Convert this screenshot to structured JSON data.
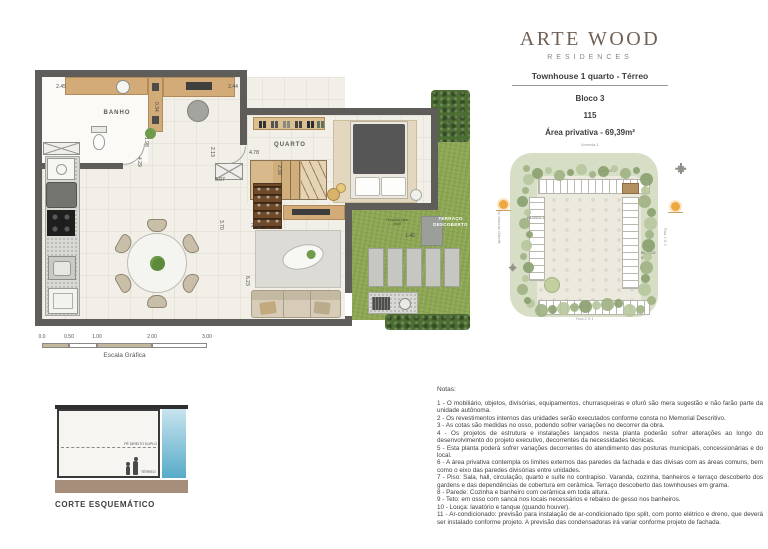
{
  "header": {
    "brand": "ARTE WOOD",
    "brand_subtitle": "RESIDENCES",
    "unit_type": "Townhouse 1 quarto - Térreo",
    "block": "Bloco 3",
    "unit_number": "115",
    "private_area": "Área privativa - 69,39m²"
  },
  "floor_plan": {
    "room_labels": {
      "bathroom": "BANHO",
      "bedroom": "QUARTO",
      "terrace": "TERRAÇO DESCOBERTO"
    },
    "terrace_note": "Previsão para ofurô",
    "dimensions": [
      "2.45",
      "2.44",
      "0.34",
      "1.98",
      "4.29",
      "2.13",
      "4.78",
      "2.39",
      "5.07",
      "3.70",
      "2.96",
      "6.23",
      "1.40",
      "5.47"
    ]
  },
  "scale_bar": {
    "ticks": [
      "0.0",
      "0.50",
      "1.00",
      "2.00",
      "3.00"
    ],
    "label": "Escala Gráfica"
  },
  "site_plan": {
    "streets": {
      "top": "Avenida 1",
      "right": "Rua 2 S 2",
      "bottom": "Rua 2 S 1",
      "left": "Av. Antonio Gabrilli"
    },
    "blocks": [
      {
        "label": "BLOCO 2"
      },
      {
        "label": "BLOCO 4"
      },
      {
        "label": "BLOCO 3"
      },
      {
        "label": "BLOCO 1"
      }
    ]
  },
  "section": {
    "title": "CORTE ESQUEMÁTICO",
    "ceiling_label": "PÉ DIREITO DUPLO",
    "floor_label": "TÉRREO"
  },
  "notes": {
    "title": "Notas:",
    "items": [
      "1 - O mobiliário, objetos, divisórias, equipamentos, churrasqueiras e ofurô são mera sugestão e não farão parte da unidade autônoma.",
      "2 - Os revestimentos internos das unidades serão executados conforme consta no Memorial Descritivo.",
      "3 - As cotas são medidas no osso, podendo sofrer variações no decorrer da obra.",
      "4 - Os projetos de estrutura e instalações lançados nesta planta poderão sofrer alterações ao longo do desenvolvimento do projeto executivo, decorrentes da necessidades técnicas.",
      "5 - Esta planta poderá sofrer variações decorrentes do atendimento das posturas municipais, concessionárias e do local.",
      "6 - A área privativa contempla os limites externos das paredes da fachada e das divisas com as áreas comuns, bem como o eixo das paredes divisórias entre unidades.",
      "7 - Piso: Sala, hall, circulação, quarto e suíte no contrapiso. Varanda, cozinha, banheiros e terraço descoberto dos gardens e das dependências de cobertura em cerâmica. Terraço descoberto das townhouses em grama.",
      "8 - Parede: Cozinha e banheiro com cerâmica em toda altura.",
      "9 - Teto: em osso com sanca nos locais necessários e rebaixo de gesso nos banheiros.",
      "10 - Louça: lavatório e tanque (quando houver).",
      "11 - Ar-condicionado: previsão para instalação de ar-condicionado tipo split, com ponto elétrico e dreno, que deverá ser instalado conforme projeto. A previsão das condensadoras irá variar conforme projeto de fachada."
    ]
  },
  "colors": {
    "brand": "#6e6054",
    "wall": "#5e5d5a",
    "wood": "#d2ab79",
    "grass": "#8ba551",
    "hedge": "#4c6e33",
    "highlight_unit": "#b3905f",
    "sky_top": "#c8e4ee",
    "sky_bottom": "#57abc9",
    "ground": "#a68e7b"
  }
}
